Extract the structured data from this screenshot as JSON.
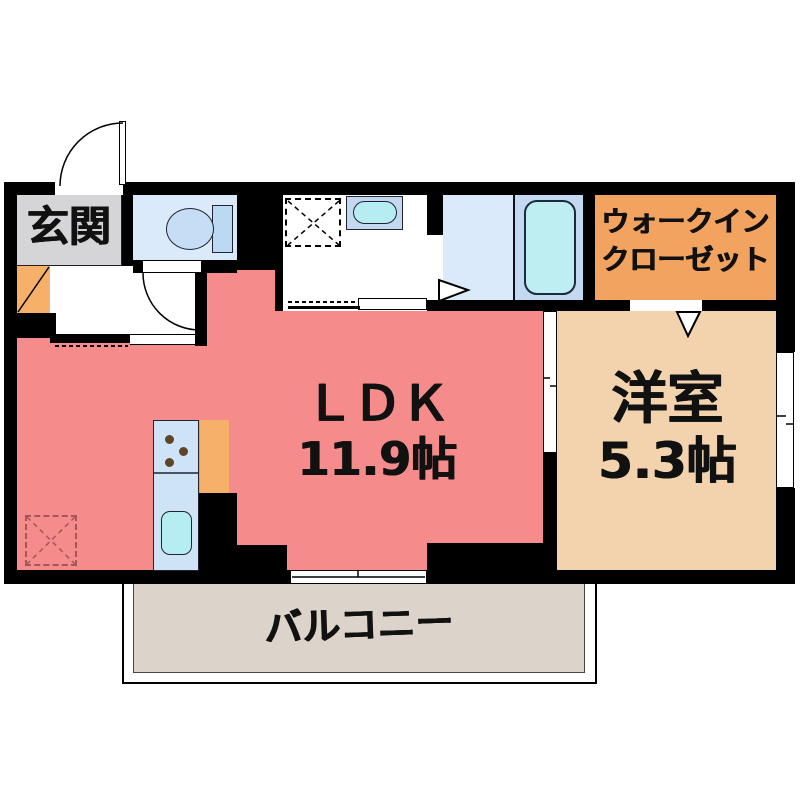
{
  "floor_plan": {
    "type": "japanese-apartment-madori",
    "labels": {
      "genkan": "玄関",
      "ldk_name": "ＬＤＫ",
      "ldk_size": "11.9帖",
      "youshitsu_name": "洋室",
      "youshitsu_size": "5.3帖",
      "wic_line1": "ウォークイン",
      "wic_line2": "クローゼット",
      "balcony": "バルコニー"
    },
    "fixtures": [
      "entrance-swing-door",
      "shoe-cabinet",
      "toilet",
      "vanity-sink",
      "washing-machine-space",
      "bathtub",
      "kitchen-counter",
      "gas-stove",
      "kitchen-sink",
      "floor-hatch",
      "walk-in-closet-opening",
      "sliding-door",
      "sliding-windows",
      "balcony"
    ],
    "colors": {
      "wall": "#000000",
      "ldk": "#f58b8b",
      "genkan": "#d5d5d7",
      "wet_blue": "#dbeafa",
      "panel_blue": "#c3d9f2",
      "fixture_cyan": "#bfeef2",
      "kitchen_blue": "#cfe3f7",
      "wic_orange": "#f2a360",
      "youshitsu_beige": "#f2d3ae",
      "balcony_gray": "#dcd4cb",
      "accent_orange": "#f6b06a",
      "burner_brown": "#5f4426",
      "hatch_red": "#a25858"
    }
  }
}
